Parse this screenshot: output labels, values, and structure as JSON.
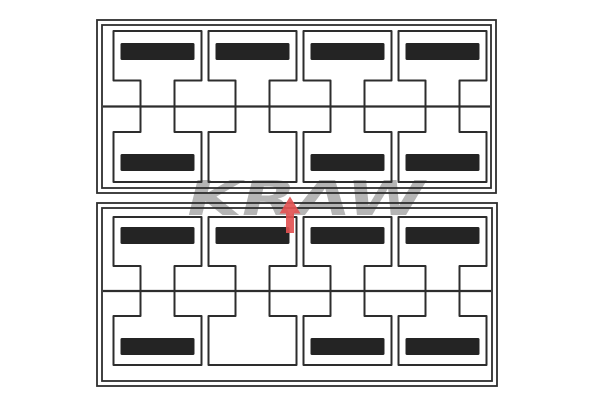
{
  "image_kind": "product-diagram",
  "watermark": {
    "text": "KRAW",
    "letters_color": "#b5b5b5",
    "arrow_color": "#e25353"
  },
  "colors": {
    "background": "#ffffff",
    "line": "#2d2d2d",
    "bar": "#242424"
  },
  "panels": [
    {
      "name": "top-panel",
      "columns": 4,
      "top_row_bars": [
        true,
        true,
        true,
        true
      ],
      "bottom_row_bars": [
        true,
        false,
        true,
        true
      ]
    },
    {
      "name": "bottom-panel",
      "columns": 4,
      "top_row_bars": [
        true,
        true,
        true,
        true
      ],
      "bottom_row_bars": [
        true,
        false,
        true,
        true
      ]
    }
  ]
}
